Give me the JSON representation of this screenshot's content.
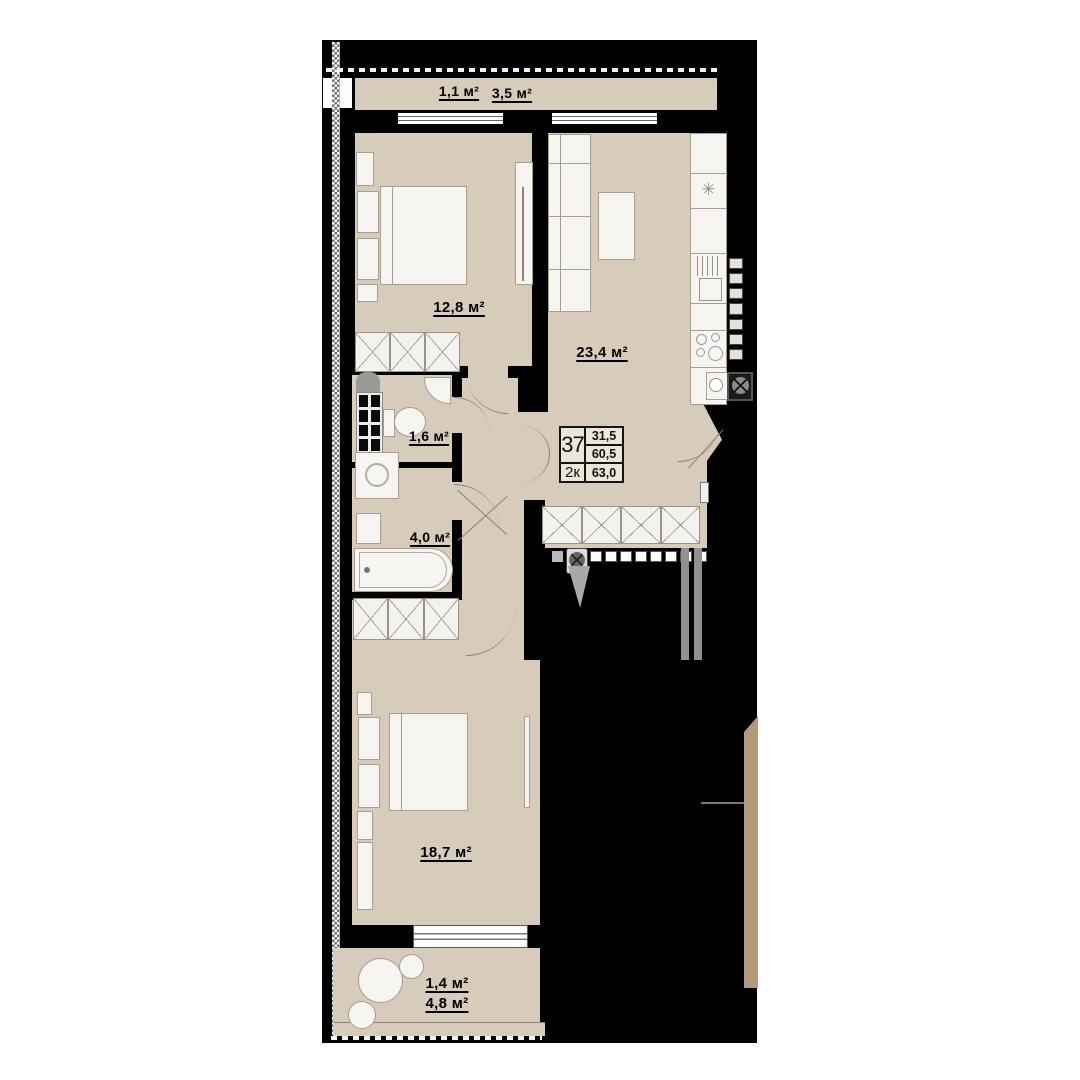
{
  "unit_card": {
    "number": "37",
    "rooms_type": "2к",
    "area_living": "31,5",
    "area_main": "60,5",
    "area_total": "63,0"
  },
  "areas": {
    "balcony_top_small": "1,1 м²",
    "balcony_top": "3,5 м²",
    "bedroom_top": "12,8 м²",
    "living_kitchen": "23,4 м²",
    "wc": "1,6 м²",
    "bathroom": "4,0 м²",
    "bedroom_bottom": "18,7 м²",
    "balcony_bottom_small": "1,4 м²",
    "balcony_bottom": "4,8 м²"
  },
  "icons": {
    "fridge": "✳"
  }
}
